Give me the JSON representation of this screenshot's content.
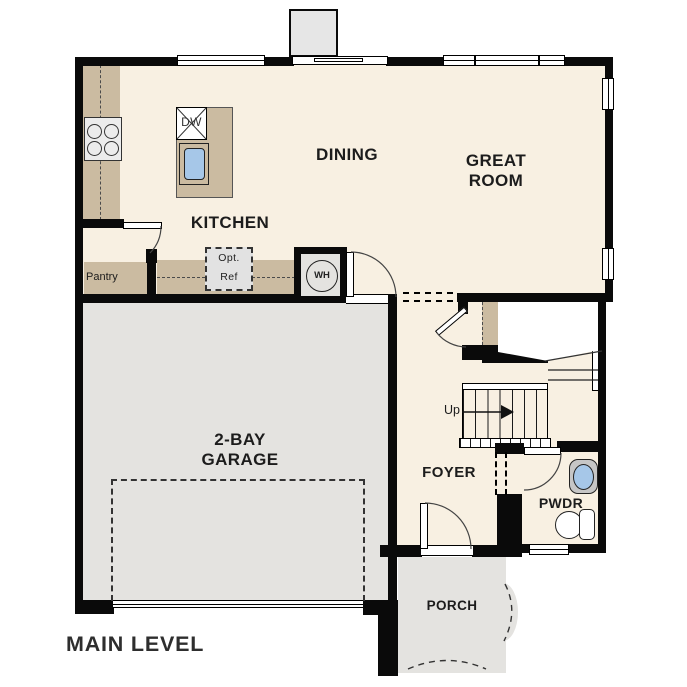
{
  "plan": {
    "level_label": "MAIN LEVEL",
    "rooms": {
      "kitchen": "KITCHEN",
      "dining": "DINING",
      "great_room": "GREAT ROOM",
      "garage": "2-BAY GARAGE",
      "foyer": "FOYER",
      "powder": "PWDR",
      "porch": "PORCH",
      "pantry": "Pantry"
    },
    "fixtures": {
      "dishwasher": "DW",
      "water_heater": "WH",
      "opt_ref_line1": "Opt.",
      "opt_ref_line2": "Ref",
      "stairs_direction": "Up"
    }
  },
  "colors": {
    "wall": "#0a0a0a",
    "floor": "#f8f0e2",
    "counter": "#cbbba1",
    "hardscape": "#e4e3e0",
    "chimney": "#e6e6e6",
    "appliance": "#ececec",
    "optref": "#e2e2e2",
    "water": "#a6c7e8",
    "text": "#1c1c1c"
  }
}
